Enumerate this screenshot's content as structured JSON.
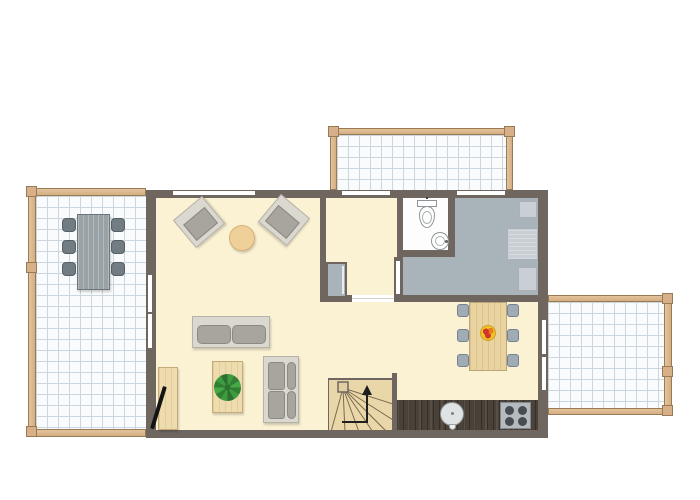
{
  "title": "apartment-ground-floor-plan",
  "colors": {
    "wall": "#6f6660",
    "floor": "#fbf1d3",
    "floor-gray": "#a8b4ba",
    "bathroom-floor": "#fdfdfd",
    "terrace-bg": "#fafbfc",
    "grid-line": "#ccd6de",
    "wood": "#d4ae83",
    "wood-border": "#9a7a55",
    "wood-post": "#d7b089",
    "stair-wood": "#ead7a9",
    "stair-line": "#7a6a4f",
    "counter": "#4a4139",
    "stove-body": "#b5babe",
    "stove-burner": "#474c52",
    "table-wood": "#e9d3a1",
    "table-wood-border": "#bfa379",
    "terrace-table": "#99a3a7",
    "terrace-table-border": "#6d7678",
    "terrace-chair": "#727d83",
    "terrace-chair-border": "#555f64",
    "chair": "#a0acb5",
    "chair-border": "#76828c",
    "sofa-frame": "#dbd8d0",
    "sofa-border": "#b5b2aa",
    "cushion": "#a8a49e",
    "cushion-border": "#8c8882",
    "sideboard": "#eedcae",
    "sideboard-border": "#c6ab7a",
    "round-table": "#efd098",
    "round-table-border": "#d8b276",
    "plant": "#3f9b40",
    "plant-dark": "#2e7030",
    "fruit-base": "#f2c12c",
    "fruit-red": "#d2362a",
    "fruit-orange": "#e87f1a",
    "tv": "#141414",
    "bedroom-furn": "#c9cfd4",
    "bedroom-furn-border": "#aab0b6",
    "fixture-border": "#8f9597",
    "window-slit": "#ffffff",
    "arrow": "#1f1f1f"
  },
  "scene": {
    "indoor_rooms": [
      "living-room",
      "dining-area",
      "open-kitchen",
      "hallway",
      "bathroom",
      "bedroom",
      "staircase"
    ],
    "outdoor_areas": [
      "left-terrace",
      "top-balcony",
      "right-terrace"
    ],
    "furniture": {
      "left-terrace": [
        "outdoor-dining-table",
        "6 outdoor chairs"
      ],
      "living-room": [
        "armchair x2",
        "round-side-table",
        "two-seat-sofa",
        "coffee-table with potted plant",
        "chaise-sofa",
        "tv-sideboard",
        "flatscreen-tv"
      ],
      "hallway": [
        "wardrobe-closet"
      ],
      "bathroom": [
        "toilet",
        "washbasin"
      ],
      "bedroom": [
        "cabinet x3"
      ],
      "dining-area": [
        "dining-table",
        "6 chairs",
        "fruit-bowl"
      ],
      "kitchen": [
        "counter-run",
        "round-sink",
        "stove with 4 burners"
      ],
      "staircase": [
        "winder-stairs",
        "up-direction-arrow"
      ]
    },
    "openings": {
      "top-wall-windows": 3,
      "left-wall-french-door-slits": 2,
      "right-wall-french-door-slits": 2,
      "hallway-door-gap": 1,
      "bedroom-door-slit": 1
    }
  }
}
